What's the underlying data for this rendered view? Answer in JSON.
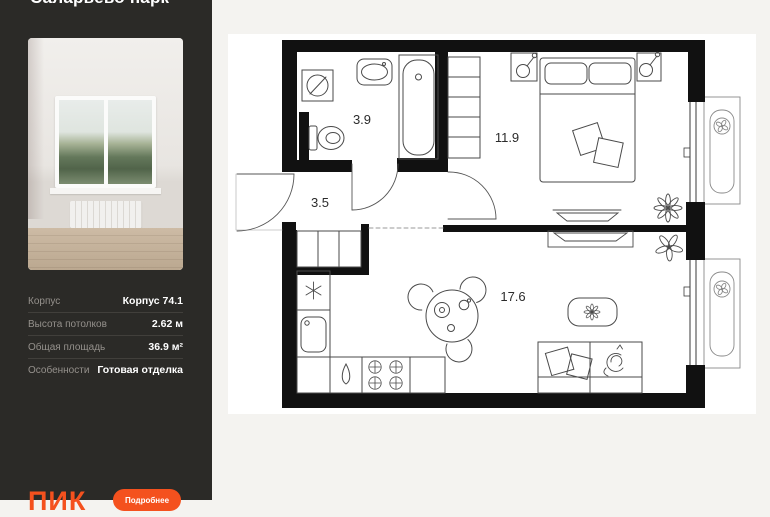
{
  "sidebar": {
    "title": "Саларьево парк",
    "specs": [
      {
        "label": "Корпус",
        "value": "Корпус 74.1"
      },
      {
        "label": "Высота потолков",
        "value": "2.62 м"
      },
      {
        "label": "Общая площадь",
        "value": "36.9 м²"
      },
      {
        "label": "Особенности",
        "value": "Готовая отделка"
      }
    ],
    "logo": "ПИК",
    "cta_label": "Подробнее"
  },
  "floorplan": {
    "rooms": [
      {
        "name": "bathroom",
        "area": "3.9"
      },
      {
        "name": "bedroom",
        "area": "11.9"
      },
      {
        "name": "hallway",
        "area": "3.5"
      },
      {
        "name": "kitchen-living",
        "area": "17.6"
      }
    ]
  },
  "colors": {
    "accent_orange": "#F4511E",
    "sidebar_bg": "#2B2A27",
    "page_bg": "#F4F3F0",
    "plan_canvas": "#FFFFFF",
    "wall": "#111111"
  }
}
